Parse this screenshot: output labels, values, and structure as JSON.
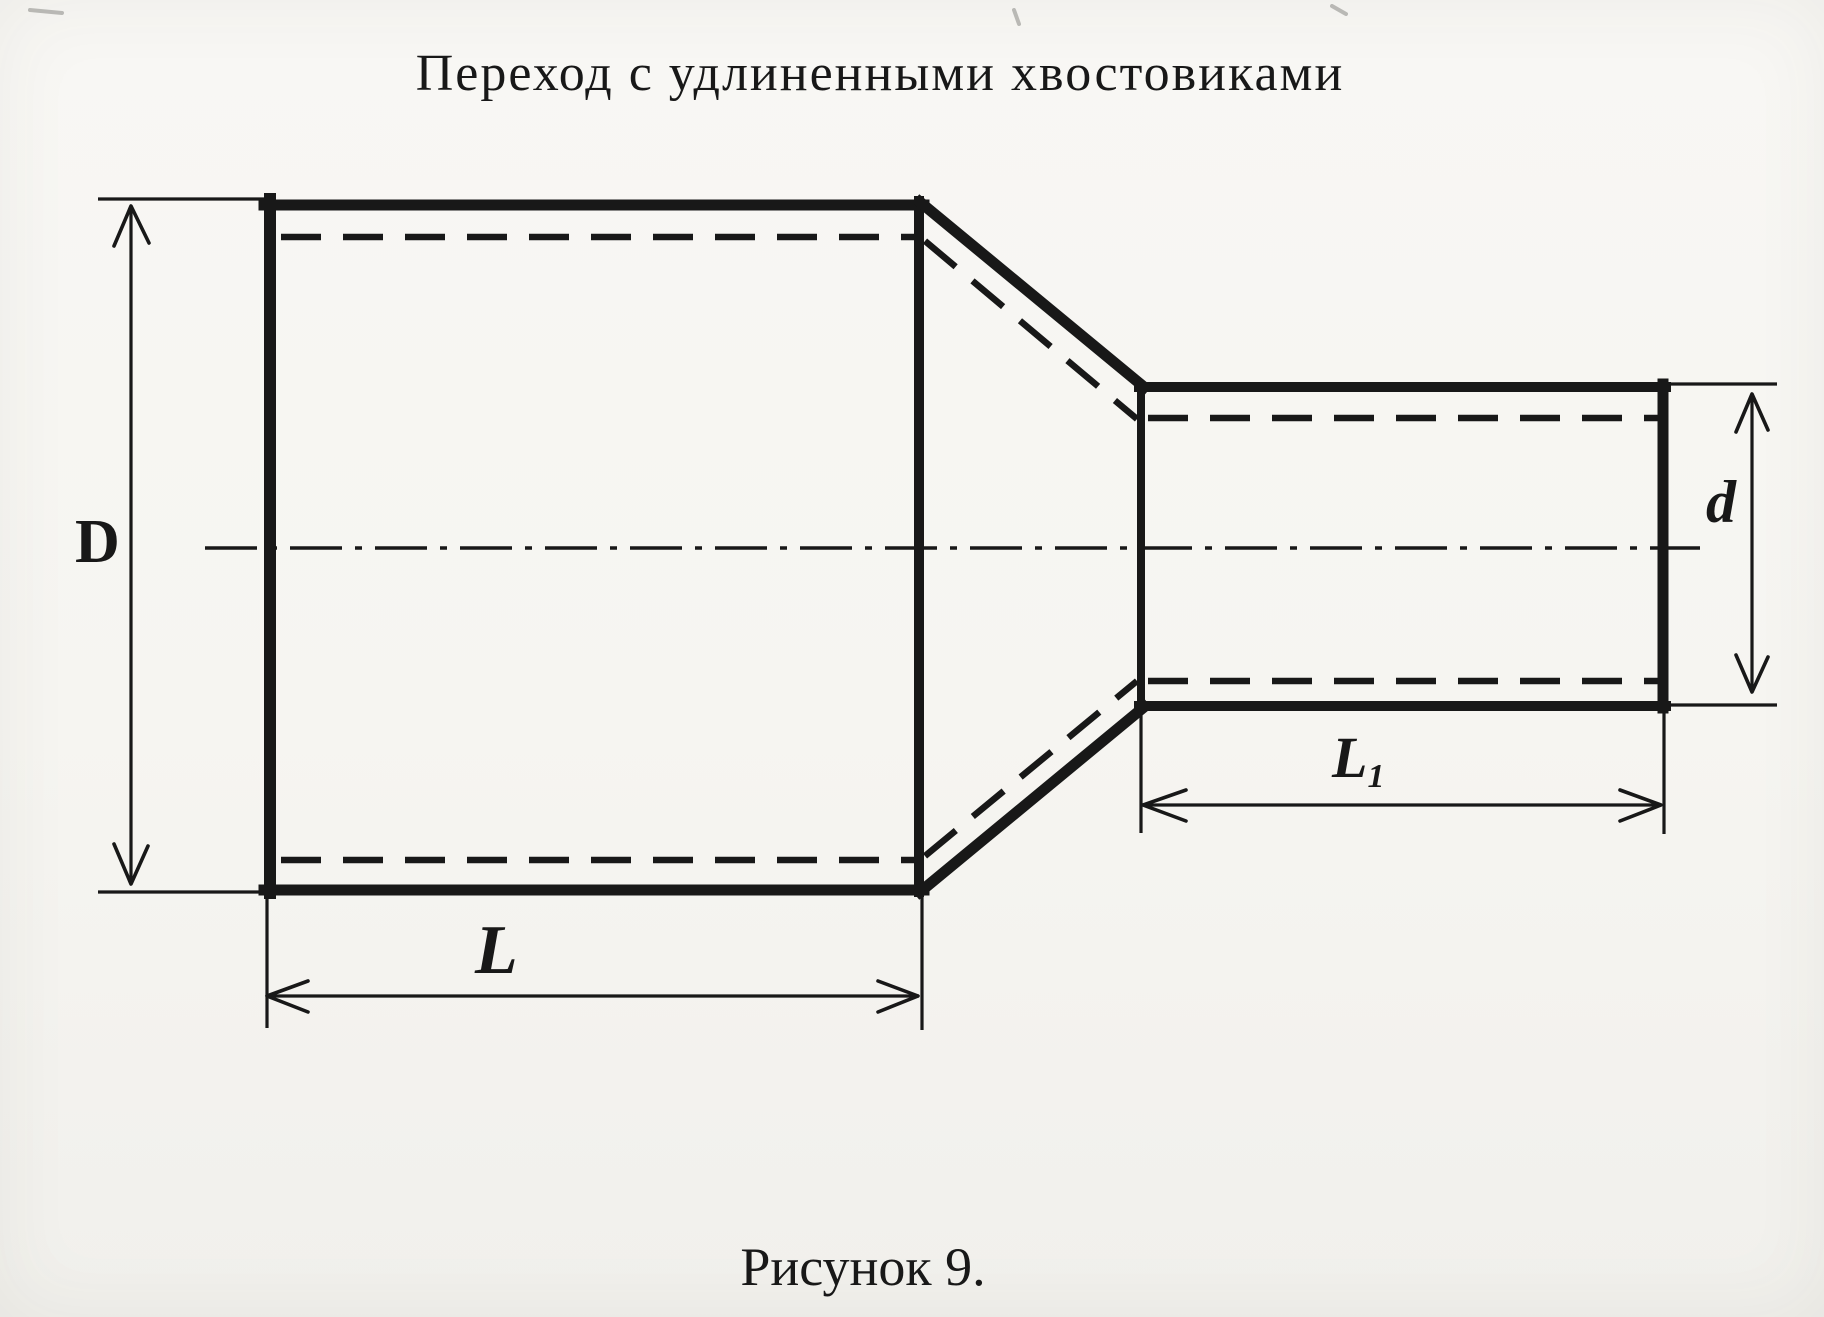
{
  "page": {
    "title": "Переход с удлиненными хвостовиками",
    "caption": "Рисунок 9."
  },
  "dimensions": {
    "large_diameter": {
      "label": "D"
    },
    "small_diameter": {
      "label": "d"
    },
    "large_length": {
      "label": "L"
    },
    "small_length": {
      "label": "L",
      "subscript": "1"
    }
  },
  "colors": {
    "ink": "#181818",
    "paper": "#f6f5f1"
  }
}
